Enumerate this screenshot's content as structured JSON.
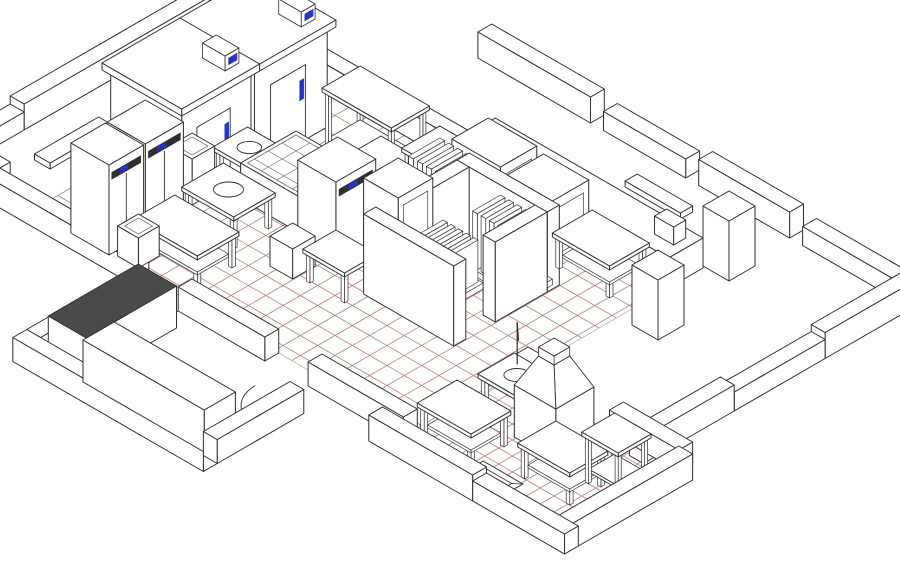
{
  "colors": {
    "paper": "#ffffff",
    "line": "#2e2e2e",
    "thin_line": "#555555",
    "tile_grid": "#b5837a",
    "accent_blue": "#2633c4",
    "panel_dark": "#2f2f2f",
    "counter_dark": "#4a4a4a",
    "island_grid": "#6a6a6a",
    "floor_edge": "#9a9a9a"
  },
  "diagram_data": {
    "type": "isometric-floor-plan",
    "subject": "commercial-kitchen-wireframe",
    "projection": {
      "origin": [
        322,
        88
      ],
      "k": 0.866,
      "t": 0.5
    },
    "floors": [
      {
        "name": "kitchen-floor-tiles",
        "x": -45,
        "y": 0,
        "w": 445,
        "d": 290,
        "step": 20
      },
      {
        "name": "dishwash-floor-tiles",
        "x": 398,
        "y": 178,
        "w": 192,
        "d": 134,
        "step": 16
      }
    ],
    "walls": [
      [
        "nw-outer-wall-a",
        -146,
        -16,
        16,
        230,
        26
      ],
      [
        "nw-outer-wall-b",
        -146,
        214,
        16,
        60,
        18
      ],
      [
        "west-corner-wall",
        -146,
        274,
        60,
        16,
        20
      ],
      [
        "annex-top-wall",
        -130,
        -16,
        290,
        16,
        26
      ],
      [
        "kitchen-east-thick-wall",
        160,
        -40,
        240,
        40,
        30
      ],
      [
        "rightroom-ne-wall-a",
        60,
        -136,
        130,
        16,
        26
      ],
      [
        "rightroom-ne-wall-b",
        205,
        -136,
        95,
        16,
        19
      ],
      [
        "rightroom-ne-wall-c",
        315,
        -136,
        105,
        16,
        26
      ],
      [
        "rightroom-ne-wall-d",
        435,
        -136,
        110,
        16,
        19
      ],
      [
        "east-outer-wall-a",
        545,
        -136,
        16,
        116,
        26
      ],
      [
        "east-outer-wall-b",
        545,
        -20,
        16,
        105,
        19
      ],
      [
        "east-outer-wall-c",
        545,
        85,
        16,
        105,
        26
      ],
      [
        "dishwash-north-wall-a",
        400,
        162,
        70,
        16,
        22
      ],
      [
        "dishwash-north-wall-b",
        510,
        162,
        80,
        16,
        22
      ],
      [
        "dishwash-east-wall",
        590,
        178,
        16,
        148,
        26
      ],
      [
        "southwing-south-wall-a",
        380,
        310,
        120,
        16,
        26
      ],
      [
        "southwing-south-wall-b",
        500,
        310,
        106,
        16,
        20
      ],
      [
        "kitchen-south-wall-a",
        -86,
        290,
        176,
        16,
        24
      ],
      [
        "kitchen-south-wall-b",
        140,
        290,
        100,
        16,
        24
      ],
      [
        "kitchen-south-wall-c",
        290,
        290,
        110,
        16,
        24
      ],
      [
        "llroom-west-wall",
        95,
        316,
        16,
        120,
        24
      ],
      [
        "llroom-south-wall",
        95,
        436,
        220,
        16,
        24
      ],
      [
        "llroom-east-wall",
        299,
        336,
        16,
        100,
        24
      ],
      [
        "core-wall-n",
        230,
        60,
        104,
        14,
        80
      ],
      [
        "core-wall-s",
        230,
        168,
        104,
        14,
        80
      ],
      [
        "core-wall-w",
        230,
        74,
        14,
        94,
        80
      ],
      [
        "core-wall-e",
        320,
        74,
        14,
        60,
        80
      ]
    ],
    "equipment": [
      {
        "name": "walk-in-cold-room-1",
        "type": "coldroom",
        "p": [
          -40,
          36,
          82,
          84,
          100
        ]
      },
      {
        "name": "walk-in-cold-room-2",
        "type": "coldroom",
        "p": [
          -40,
          124,
          82,
          80,
          100
        ]
      },
      {
        "name": "upright-fridge-left-1",
        "type": "fridge",
        "p": [
          0,
          204,
          44,
          44,
          90
        ],
        "doors": 2
      },
      {
        "name": "upright-fridge-left-2",
        "type": "fridge",
        "p": [
          0,
          250,
          44,
          40,
          90
        ],
        "doors": 2
      },
      {
        "name": "waste-bin-1",
        "type": "bin",
        "p": [
          8,
          158,
          26,
          26,
          38
        ]
      },
      {
        "name": "waste-bin-2",
        "type": "bin",
        "p": [
          50,
          262,
          24,
          24,
          30
        ]
      },
      {
        "name": "prep-table-left",
        "type": "table",
        "p": [
          58,
          228,
          70,
          44,
          34
        ],
        "undershelf": true
      },
      {
        "name": "sink-table-left",
        "type": "sinktable",
        "p": [
          54,
          168,
          56,
          44,
          34
        ]
      },
      {
        "name": "cooking-island-range",
        "type": "island",
        "p": [
          64,
          94,
          116,
          64,
          36
        ]
      },
      {
        "name": "kitchen-stool",
        "type": "box",
        "p": [
          148,
          182,
          26,
          26,
          30
        ]
      },
      {
        "name": "upright-fridge-center",
        "type": "fridge",
        "p": [
          146,
          128,
          44,
          46,
          88
        ],
        "doors": 1
      },
      {
        "name": "center-prep-table",
        "type": "table",
        "p": [
          118,
          50,
          64,
          40,
          34
        ],
        "undershelf": true
      },
      {
        "name": "round-sink-stand",
        "type": "sinktable",
        "p": [
          32,
          118,
          40,
          36,
          34
        ]
      },
      {
        "name": "open-shelf-unit",
        "type": "openshelf",
        "p": [
          68,
          24,
          76,
          40,
          66
        ]
      },
      {
        "name": "service-trolley",
        "type": "openshelf",
        "p": [
          154,
          18,
          34,
          40,
          46
        ]
      },
      {
        "name": "oven-1",
        "type": "panelbox",
        "p": [
          194,
          2,
          56,
          42,
          68
        ]
      },
      {
        "name": "oven-2",
        "type": "panelbox",
        "p": [
          256,
          0,
          52,
          42,
          62
        ]
      },
      {
        "name": "ne-prep-table",
        "type": "table",
        "p": [
          314,
          2,
          62,
          42,
          34
        ],
        "undershelf": true
      },
      {
        "name": "slatted-rack-bank-1",
        "type": "slatted",
        "p": [
          194,
          56,
          72,
          40,
          76
        ],
        "fins": 7
      },
      {
        "name": "slatted-rack-bank-2",
        "type": "slatted",
        "p": [
          272,
          64,
          58,
          36,
          62
        ],
        "fins": 6
      },
      {
        "name": "slatted-rack-bank-3",
        "type": "slatted",
        "p": [
          250,
          108,
          44,
          30,
          48
        ],
        "fins": 5
      },
      {
        "name": "tall-cabinet",
        "type": "panelbox",
        "p": [
          198,
          110,
          40,
          40,
          84
        ]
      },
      {
        "name": "core-side-table",
        "type": "table",
        "p": [
          184,
          168,
          44,
          34,
          32
        ]
      },
      {
        "name": "structural-pillar-1",
        "type": "box",
        "p": [
          398,
          -72,
          30,
          30,
          60
        ]
      },
      {
        "name": "structural-pillar-2",
        "type": "box",
        "p": [
          416,
          28,
          30,
          30,
          60
        ]
      },
      {
        "name": "hood-dishwasher",
        "type": "hood",
        "p": [
          460,
          194,
          48,
          44,
          52
        ]
      },
      {
        "name": "prerinse-sink-table",
        "type": "sinktable",
        "p": [
          412,
          190,
          44,
          38,
          34
        ],
        "faucet": true
      },
      {
        "name": "dishwash-table-1",
        "type": "table",
        "p": [
          406,
          250,
          58,
          42,
          34
        ],
        "undershelf": true
      },
      {
        "name": "dishwash-table-2",
        "type": "table",
        "p": [
          504,
          234,
          56,
          40,
          34
        ],
        "undershelf": true
      },
      {
        "name": "dishwash-shelf-unit",
        "type": "openshelf",
        "p": [
          546,
          208,
          38,
          34,
          50
        ]
      },
      {
        "name": "lowerleft-counter-a",
        "type": "box",
        "p": [
          112,
          324,
          44,
          104,
          42
        ],
        "darkTop": true
      },
      {
        "name": "lowerleft-counter-b",
        "type": "box",
        "p": [
          156,
          396,
          140,
          36,
          42
        ]
      },
      {
        "name": "wall-shelf-left",
        "type": "box",
        "p": [
          -42,
          216,
          18,
          74,
          6
        ],
        "zb": 52
      },
      {
        "name": "wall-shelf-ne",
        "type": "box",
        "p": [
          330,
          -34,
          64,
          14,
          6
        ],
        "zb": 56
      },
      {
        "name": "wall-mounted-box",
        "type": "box",
        "p": [
          368,
          -30,
          22,
          14,
          18
        ],
        "zb": 30
      }
    ],
    "pits": [
      {
        "name": "floor-drain-pit",
        "x": 466,
        "y": 280,
        "w": 46,
        "d": 36
      }
    ],
    "arcs": [
      {
        "name": "door-swing-arc-1",
        "cx": 140,
        "cy": 306,
        "r": 50,
        "a0": 90,
        "a1": 180
      },
      {
        "name": "door-swing-arc-2",
        "cx": 299,
        "cy": 336,
        "r": 40,
        "a0": 90,
        "a1": 180
      }
    ]
  }
}
